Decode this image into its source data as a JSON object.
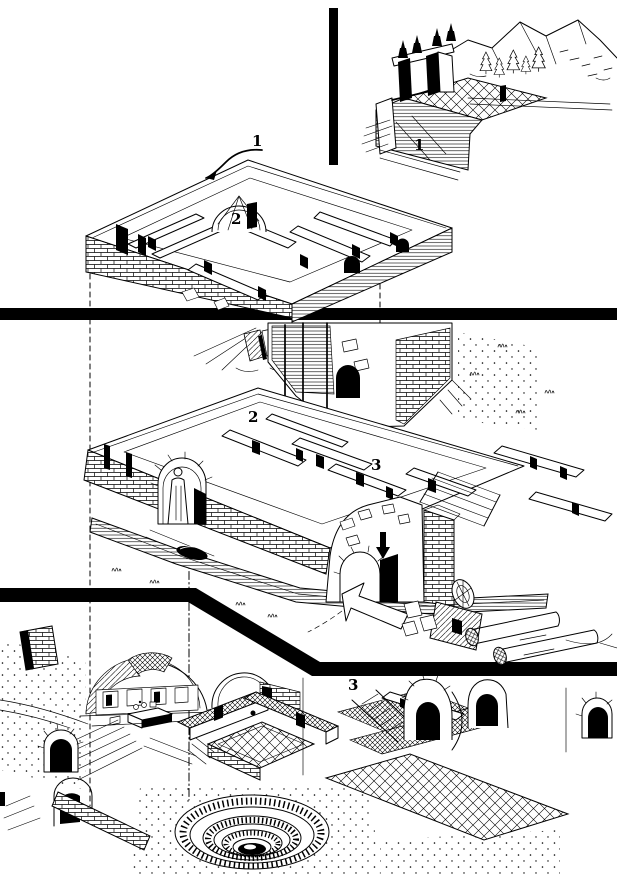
{
  "figure": {
    "colors": {
      "ink": "#000000",
      "paper": "#ffffff"
    },
    "callouts": {
      "inset_terrace": "1",
      "upper_entry": "1",
      "upper_dome": "2",
      "middle_floor": "2",
      "middle_rooms": "3",
      "lower_floor": "3"
    }
  }
}
